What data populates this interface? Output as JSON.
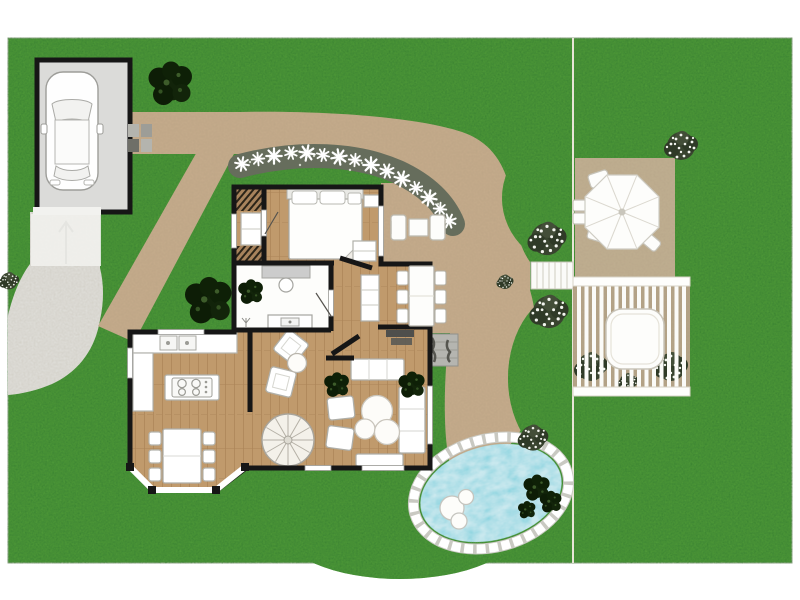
{
  "title": "Residential garden site plan with single-storey house floor plan",
  "visible_text": [],
  "palette": {
    "page": "#ffffff",
    "grass": "#54a13a",
    "path": "#c8ad8d",
    "deck": "#c6b092",
    "patio": "#c2b193",
    "pergola_floor": "#b7a68a",
    "driveway": "#e4e4e0",
    "apron": "#f2f2ef",
    "garage_floor": "#dbdbd9",
    "wood_floor": "#c09a6c",
    "bathroom_floor": "#fdfdfb",
    "wall": "#161616",
    "water": "#57c9d8",
    "coping": "#ffffff",
    "gravel": "#666d5c",
    "foliage_dark": "#12240a",
    "flower_bush": "#3c4435",
    "furniture": "#ffffff"
  },
  "site": {
    "lawn": {
      "name": "lawn",
      "texture": "mottled grass"
    },
    "property_line": {
      "name": "property boundary line",
      "orientation": "vertical"
    },
    "garage": {
      "name": "garage",
      "contains": "car seen from above",
      "door_marker": "up arrow on apron"
    },
    "driveway": {
      "name": "curved driveway to street"
    },
    "paths": {
      "name": "sand-coloured garden path",
      "segments": [
        "garage to house",
        "diagonal to driveway",
        "curve around house to pool"
      ]
    },
    "flower_border": {
      "name": "gravel flower border",
      "flower_count": 15,
      "flower_color": "#ffffff"
    },
    "house": {
      "rooms": [
        {
          "name": "bedroom",
          "furniture": [
            "double bed with pillows",
            "nightstand",
            "dresser"
          ]
        },
        {
          "name": "hallway-closet",
          "furniture": [
            "slatted storage",
            "wardrobe"
          ]
        },
        {
          "name": "bathroom",
          "furniture": [
            "vanity with stool",
            "washbasin counter",
            "plant"
          ]
        },
        {
          "name": "hall",
          "furniture": [
            "sideboard",
            "doormat",
            "tv console"
          ]
        },
        {
          "name": "kitchen",
          "furniture": [
            "counter with double sink",
            "island with cooktop",
            "bay-window dining table with 6 chairs"
          ]
        },
        {
          "name": "lounge",
          "furniture": [
            "2 floor cushions",
            "round side table",
            "spiral staircase"
          ]
        },
        {
          "name": "living room",
          "furniture": [
            "corner sofa",
            "2 armchairs",
            "3 round coffee tables",
            "bench",
            "2 potted plants"
          ]
        }
      ]
    },
    "outdoor": {
      "terrace_lounge": {
        "name": "terrace lounge set",
        "items": [
          "2 armchairs",
          "side table"
        ]
      },
      "terrace_dining": {
        "name": "terrace dining set",
        "chairs": 6
      },
      "umbrella_patio": {
        "name": "patio with parasol",
        "chairs": 4
      },
      "pergola": {
        "name": "slatted pergola with hot tub",
        "slats": 15
      },
      "plank_walkway": {
        "name": "white plank walkway"
      },
      "entrance_steps": {
        "name": "stone entrance steps"
      },
      "pool": {
        "name": "swimming pool",
        "floats": 3,
        "edge": "white stone coping"
      }
    },
    "vegetation": {
      "trees": [
        "tree beside garage",
        "tree left of house"
      ],
      "flower_bushes": [
        "two beside walkway",
        "patio corner",
        "above pool",
        "left lawn edge"
      ],
      "rocks": "dark planting on pool edge"
    }
  }
}
